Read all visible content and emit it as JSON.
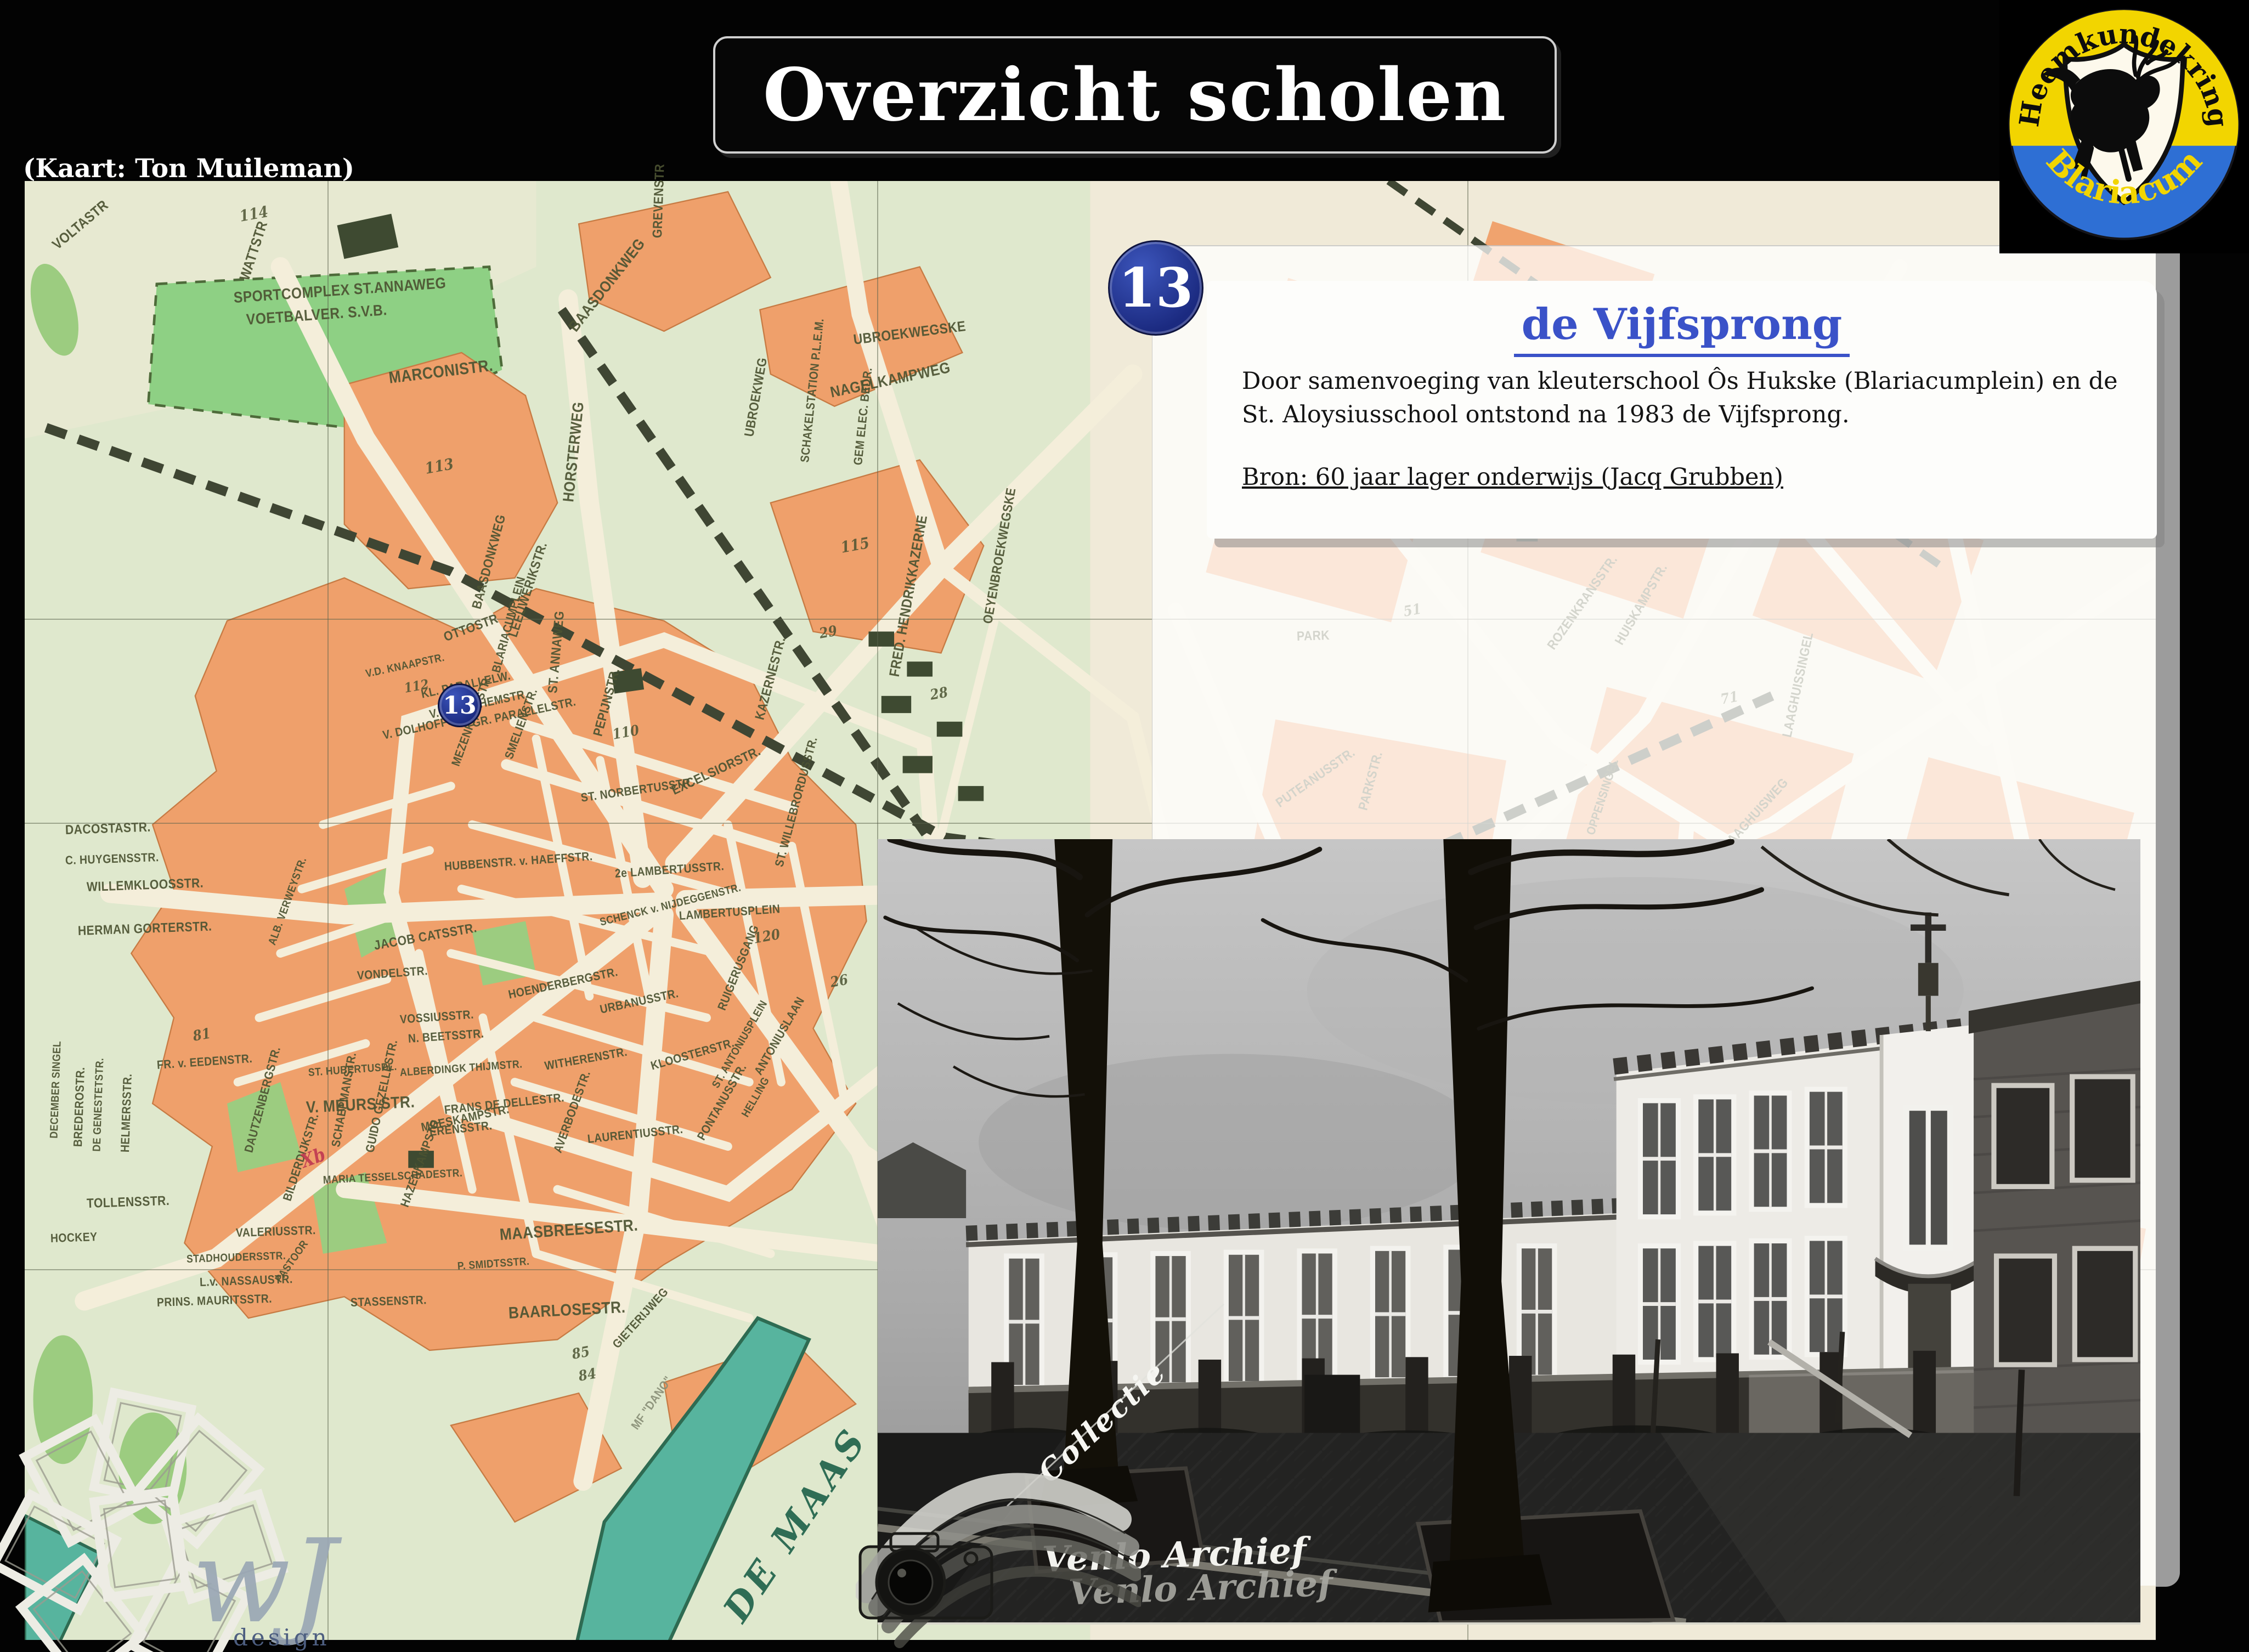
{
  "slide": {
    "title": "Overzicht scholen",
    "map_credit": "(Kaart: Ton Muileman)"
  },
  "logo": {
    "top": "Heemkundekring",
    "bottom": "Blariacum"
  },
  "marker": {
    "number": "13"
  },
  "card": {
    "title": "de Vijfsprong",
    "body": [
      "Door samenvoeging van kleuterschool Ôs Hukske (Blariacumplein) en de",
      "St. Aloysiusschool ontstond na 1983 de Vijfsprong."
    ],
    "source": "Bron: 60 jaar lager onderwijs (Jacq Grubben)"
  },
  "map": {
    "river_label": "DE MAAS",
    "labels": [
      {
        "t": "VOLTASTR",
        "x": 1.4,
        "y": 3.9,
        "r": -40,
        "fs": 26
      },
      {
        "t": "WATTSTR",
        "x": 10.3,
        "y": 6.2,
        "r": -72,
        "fs": 26
      },
      {
        "t": "MARCONISTR.",
        "x": 17.1,
        "y": 12.9,
        "r": -7,
        "fs": 30
      },
      {
        "t": "SPORTCOMPLEX  ST.ANNAWEG",
        "x": 9.8,
        "y": 7.4,
        "r": -4,
        "fs": 28
      },
      {
        "t": "VOETBALVER.  S.V.B.",
        "x": 10.4,
        "y": 8.9,
        "r": -4,
        "fs": 28
      },
      {
        "t": "BAASDONKWEG",
        "x": 25.7,
        "y": 9.6,
        "r": -52,
        "fs": 28
      },
      {
        "t": "BAASDONKWEG",
        "x": 21.2,
        "y": 28.8,
        "r": -75,
        "fs": 24
      },
      {
        "t": "ST. ANNAWEG",
        "x": 24.8,
        "y": 34.6,
        "r": -85,
        "fs": 24
      },
      {
        "t": "NAGELKAMPWEG",
        "x": 37.8,
        "y": 13.9,
        "r": -12,
        "fs": 28
      },
      {
        "t": "UBROEKWEGSKE",
        "x": 38.9,
        "y": 10.3,
        "r": -7,
        "fs": 26
      },
      {
        "t": "GREVENSTR",
        "x": 29.7,
        "y": 3.4,
        "r": -88,
        "fs": 24
      },
      {
        "t": "UBROEKWEG",
        "x": 34.0,
        "y": 17.0,
        "r": -80,
        "fs": 24
      },
      {
        "t": "HORSTERWEG",
        "x": 25.5,
        "y": 21.4,
        "r": -84,
        "fs": 28
      },
      {
        "t": "SCHAKELSTATION  P.L.E.M.",
        "x": 36.6,
        "y": 18.8,
        "r": -84,
        "fs": 22
      },
      {
        "t": "GEM ELEC. BEDR.",
        "x": 39.1,
        "y": 19.0,
        "r": -84,
        "fs": 22
      },
      {
        "t": "OEYENBROEKWEGSKE",
        "x": 45.2,
        "y": 29.8,
        "r": -80,
        "fs": 24
      },
      {
        "t": "FRED. HENDRIKKAZERNE",
        "x": 40.8,
        "y": 33.4,
        "r": -80,
        "fs": 26
      },
      {
        "t": "KAZERNESTR.",
        "x": 34.5,
        "y": 36.4,
        "r": -75,
        "fs": 24
      },
      {
        "t": "PEPIJNSTR.",
        "x": 26.9,
        "y": 37.5,
        "r": -75,
        "fs": 24
      },
      {
        "t": "LEEUWERIKSTR.",
        "x": 22.9,
        "y": 30.7,
        "r": -72,
        "fs": 24
      },
      {
        "t": "OTTOSTR",
        "x": 19.7,
        "y": 30.8,
        "r": -20,
        "fs": 24
      },
      {
        "t": "BLARIACUMPLEIN",
        "x": 22.1,
        "y": 33.2,
        "r": -75,
        "fs": 22
      },
      {
        "t": "V.D. KNAAPSTR.",
        "x": 16.0,
        "y": 33.4,
        "r": -12,
        "fs": 20
      },
      {
        "t": "KL. PARALLELW.",
        "x": 18.6,
        "y": 34.7,
        "r": -12,
        "fs": 22
      },
      {
        "t": "V. STOCKHEMSTR.",
        "x": 19.0,
        "y": 36.1,
        "r": -12,
        "fs": 22
      },
      {
        "t": "GR. PARALLELSTR.",
        "x": 21.0,
        "y": 36.7,
        "r": -12,
        "fs": 22
      },
      {
        "t": "V. DOLHOFFSTR.",
        "x": 16.8,
        "y": 37.5,
        "r": -12,
        "fs": 22
      },
      {
        "t": "MEZENKAMPSTR.",
        "x": 20.2,
        "y": 39.6,
        "r": -70,
        "fs": 22
      },
      {
        "t": "SMELIENSTR.",
        "x": 22.7,
        "y": 39.1,
        "r": -70,
        "fs": 22
      },
      {
        "t": "EXCELSIORSTR.",
        "x": 30.4,
        "y": 41.3,
        "r": -25,
        "fs": 24
      },
      {
        "t": "ST. NORBERTUSSTR.",
        "x": 26.1,
        "y": 41.8,
        "r": -8,
        "fs": 22
      },
      {
        "t": "ST. WILLEBRORDUSSTR.",
        "x": 35.4,
        "y": 46.5,
        "r": -75,
        "fs": 22
      },
      {
        "t": "WILLEMKLOOSSTR.",
        "x": 2.9,
        "y": 47.9,
        "r": -2,
        "fs": 24
      },
      {
        "t": "HERMAN GORTERSTR.",
        "x": 2.5,
        "y": 50.9,
        "r": -2,
        "fs": 24
      },
      {
        "t": "DACOSTASTR.",
        "x": 1.9,
        "y": 44.0,
        "r": -2,
        "fs": 24
      },
      {
        "t": "C. HUYGENSSTR.",
        "x": 1.9,
        "y": 46.1,
        "r": -2,
        "fs": 22
      },
      {
        "t": "JACOB CATSSTR.",
        "x": 16.4,
        "y": 51.9,
        "r": -10,
        "fs": 24
      },
      {
        "t": "HUBBENSTR. v. HAEFFSTR.",
        "x": 19.7,
        "y": 46.5,
        "r": -4,
        "fs": 22
      },
      {
        "t": "2e LAMBERTUSSTR.",
        "x": 27.7,
        "y": 47.0,
        "r": -4,
        "fs": 22
      },
      {
        "t": "LAMBERTUSPLEIN",
        "x": 30.7,
        "y": 49.9,
        "r": -4,
        "fs": 22
      },
      {
        "t": "SCHENCK v. NIJDEGGENSTR.",
        "x": 27.0,
        "y": 50.4,
        "r": -14,
        "fs": 20
      },
      {
        "t": "HOENDERBERGSTR.",
        "x": 22.7,
        "y": 55.3,
        "r": -12,
        "fs": 22
      },
      {
        "t": "URBANUSSTR.",
        "x": 27.0,
        "y": 56.3,
        "r": -12,
        "fs": 22
      },
      {
        "t": "RUIGERUSGANG",
        "x": 32.7,
        "y": 56.3,
        "r": -68,
        "fs": 22
      },
      {
        "t": "VONDELSTR.",
        "x": 15.6,
        "y": 54.0,
        "r": -4,
        "fs": 22
      },
      {
        "t": "ALB. VERWEYSTR.",
        "x": 11.6,
        "y": 51.9,
        "r": -70,
        "fs": 20
      },
      {
        "t": "VOSSIUSSTR.",
        "x": 17.6,
        "y": 57.0,
        "r": -4,
        "fs": 22
      },
      {
        "t": "N. BEETSSTR.",
        "x": 18.0,
        "y": 58.3,
        "r": -4,
        "fs": 22
      },
      {
        "t": "FR. v. EEDENSTR.",
        "x": 6.2,
        "y": 60.1,
        "r": -4,
        "fs": 22
      },
      {
        "t": "ST. HUBERTUSPL.",
        "x": 13.3,
        "y": 60.7,
        "r": -4,
        "fs": 20
      },
      {
        "t": "ALBERDINGK THIJMSTR.",
        "x": 17.6,
        "y": 60.7,
        "r": -4,
        "fs": 20
      },
      {
        "t": "WITHERENSTR.",
        "x": 24.4,
        "y": 60.2,
        "r": -10,
        "fs": 22
      },
      {
        "t": "KLOOSTERSTR.",
        "x": 29.4,
        "y": 60.2,
        "r": -16,
        "fs": 22
      },
      {
        "t": "ST. ANTONIUSPLEIN",
        "x": 32.4,
        "y": 61.7,
        "r": -60,
        "fs": 20
      },
      {
        "t": "ANTONIUSLAAN",
        "x": 34.4,
        "y": 60.7,
        "r": -60,
        "fs": 22
      },
      {
        "t": "V. MEURS STR.",
        "x": 13.2,
        "y": 62.9,
        "r": -3,
        "fs": 30
      },
      {
        "t": "DAUTZENBERGSTR.",
        "x": 10.5,
        "y": 66.1,
        "r": -75,
        "fs": 22
      },
      {
        "t": "BILDERDIJKSTR.",
        "x": 12.3,
        "y": 69.4,
        "r": -72,
        "fs": 22
      },
      {
        "t": "SCHAEPMANSTR.",
        "x": 14.6,
        "y": 65.7,
        "r": -80,
        "fs": 22
      },
      {
        "t": "MARIA TESSELSCHADESTR.",
        "x": 14.0,
        "y": 68.1,
        "r": -3,
        "fs": 20
      },
      {
        "t": "GUIDO GEZELLESTR.",
        "x": 16.2,
        "y": 66.1,
        "r": -78,
        "fs": 22
      },
      {
        "t": "HAZENKAMPSTR.",
        "x": 17.8,
        "y": 69.8,
        "r": -70,
        "fs": 22
      },
      {
        "t": "FRANS DE DELLESTR.",
        "x": 19.7,
        "y": 63.2,
        "r": -6,
        "fs": 22
      },
      {
        "t": "ERENSSTR.",
        "x": 19.0,
        "y": 64.7,
        "r": -6,
        "fs": 22
      },
      {
        "t": "LAURENTIUSSTR.",
        "x": 26.4,
        "y": 65.2,
        "r": -6,
        "fs": 22
      },
      {
        "t": "MOESKAMPSTR.",
        "x": 18.6,
        "y": 64.4,
        "r": -12,
        "fs": 22
      },
      {
        "t": "AVERBODESTR.",
        "x": 25.0,
        "y": 66.1,
        "r": -70,
        "fs": 22
      },
      {
        "t": "PONTANUSSTR.",
        "x": 31.7,
        "y": 65.2,
        "r": -60,
        "fs": 22
      },
      {
        "t": "HELLING",
        "x": 33.8,
        "y": 63.7,
        "r": -60,
        "fs": 20
      },
      {
        "t": "BREDEROSTR.",
        "x": 2.5,
        "y": 65.7,
        "r": -88,
        "fs": 22
      },
      {
        "t": "DE GENESTETSTR.",
        "x": 3.4,
        "y": 66.1,
        "r": -88,
        "fs": 20
      },
      {
        "t": "HELMERSSTR.",
        "x": 4.7,
        "y": 66.1,
        "r": -88,
        "fs": 22
      },
      {
        "t": "DECEMBER SINGEL",
        "x": 1.4,
        "y": 65.2,
        "r": -88,
        "fs": 20
      },
      {
        "t": "TOLLENSSTR.",
        "x": 2.9,
        "y": 69.6,
        "r": -2,
        "fs": 24
      },
      {
        "t": "MAASBREESESTR.",
        "x": 22.3,
        "y": 71.6,
        "r": -4,
        "fs": 30
      },
      {
        "t": "VALERIUSSTR.",
        "x": 9.9,
        "y": 71.6,
        "r": -2,
        "fs": 22
      },
      {
        "t": "HOCKEY",
        "x": 1.2,
        "y": 72.0,
        "r": -2,
        "fs": 22
      },
      {
        "t": "STADHOUDERSSTR.",
        "x": 7.6,
        "y": 73.5,
        "r": -2,
        "fs": 20
      },
      {
        "t": "L.v. NASSAUSTR.",
        "x": 8.2,
        "y": 75.0,
        "r": -2,
        "fs": 22
      },
      {
        "t": "PASTOOR",
        "x": 11.9,
        "y": 75.0,
        "r": -55,
        "fs": 20
      },
      {
        "t": "STASSENSTR.",
        "x": 15.3,
        "y": 76.4,
        "r": -2,
        "fs": 22
      },
      {
        "t": "PRINS. MAURITSSTR.",
        "x": 6.2,
        "y": 76.4,
        "r": -2,
        "fs": 22
      },
      {
        "t": "P. SMIDTSSTR.",
        "x": 20.3,
        "y": 74.0,
        "r": -4,
        "fs": 20
      },
      {
        "t": "BAARLOSESTR.",
        "x": 22.7,
        "y": 77.0,
        "r": -3,
        "fs": 30
      },
      {
        "t": "GIETERIJWEG",
        "x": 27.7,
        "y": 79.4,
        "r": -48,
        "fs": 22
      },
      {
        "t": "MF \"DANO\"",
        "x": 28.6,
        "y": 85.0,
        "r": -55,
        "fs": 22,
        "c": "mghost"
      },
      {
        "t": "Xb",
        "x": 13.0,
        "y": 66.5,
        "r": -20,
        "fs": 34,
        "c": "mred"
      },
      {
        "t": "PARK",
        "x": 59.7,
        "y": 30.7,
        "r": -2,
        "fs": 24
      },
      {
        "t": "PUTEANUSSTR.",
        "x": 58.8,
        "y": 42.2,
        "r": -35,
        "fs": 24
      },
      {
        "t": "PARKSTR.",
        "x": 62.8,
        "y": 42.6,
        "r": -75,
        "fs": 24
      },
      {
        "t": "ROZENKRANSSTR.",
        "x": 71.6,
        "y": 31.5,
        "r": -55,
        "fs": 24
      },
      {
        "t": "HUISKAMPSTR.",
        "x": 74.8,
        "y": 31.2,
        "r": -60,
        "fs": 24
      },
      {
        "t": "DEKEN v. OPPENSINGEL",
        "x": 72.7,
        "y": 47.8,
        "r": -72,
        "fs": 22
      },
      {
        "t": "MERCATORSTR.",
        "x": 70.3,
        "y": 53.9,
        "r": -58,
        "fs": 24
      },
      {
        "t": "ST. MARTINUSSTR.",
        "x": 62.6,
        "y": 53.4,
        "r": -72,
        "fs": 22
      },
      {
        "t": "WILHELMINASINGEL",
        "x": 66.0,
        "y": 53.6,
        "r": -78,
        "fs": 22
      },
      {
        "t": "LAAGHUISSINGEL",
        "x": 82.7,
        "y": 37.6,
        "r": -78,
        "fs": 24
      },
      {
        "t": "LAAGHUISWEG",
        "x": 79.8,
        "y": 45.2,
        "r": -48,
        "fs": 24
      },
      {
        "t": "RIJNBEEKSTR.",
        "x": 80.4,
        "y": 58.1,
        "r": -38,
        "fs": 24
      },
      {
        "t": "MULDERSTR.",
        "x": 75.3,
        "y": 61.0,
        "r": -8,
        "fs": 24
      },
      {
        "t": "114",
        "x": 10.1,
        "y": 1.8,
        "r": -10,
        "fs": 28,
        "c": "mnum"
      },
      {
        "t": "113",
        "x": 18.8,
        "y": 19.1,
        "r": -10,
        "fs": 28,
        "c": "mnum"
      },
      {
        "t": "115",
        "x": 38.3,
        "y": 24.5,
        "r": -10,
        "fs": 28,
        "c": "mnum"
      },
      {
        "t": "112",
        "x": 17.8,
        "y": 34.2,
        "r": -10,
        "fs": 24,
        "c": "mnum"
      },
      {
        "t": "29",
        "x": 37.3,
        "y": 30.5,
        "r": -10,
        "fs": 26,
        "c": "mnum"
      },
      {
        "t": "28",
        "x": 42.5,
        "y": 34.7,
        "r": -10,
        "fs": 26,
        "c": "mnum"
      },
      {
        "t": "110",
        "x": 27.6,
        "y": 37.4,
        "r": -10,
        "fs": 26,
        "c": "mnum"
      },
      {
        "t": "120",
        "x": 34.2,
        "y": 51.4,
        "r": -10,
        "fs": 26,
        "c": "mnum"
      },
      {
        "t": "26",
        "x": 37.8,
        "y": 54.4,
        "r": -10,
        "fs": 26,
        "c": "mnum"
      },
      {
        "t": "81",
        "x": 7.9,
        "y": 58.1,
        "r": -10,
        "fs": 26,
        "c": "mnum"
      },
      {
        "t": "85",
        "x": 25.7,
        "y": 79.9,
        "r": -10,
        "fs": 26,
        "c": "mnum"
      },
      {
        "t": "84",
        "x": 26.0,
        "y": 81.4,
        "r": -10,
        "fs": 26,
        "c": "mnum"
      },
      {
        "t": "51",
        "x": 64.7,
        "y": 29.0,
        "r": -10,
        "fs": 26,
        "c": "mnum"
      },
      {
        "t": "71",
        "x": 79.6,
        "y": 35.0,
        "r": -10,
        "fs": 26,
        "c": "mnum"
      },
      {
        "t": "90",
        "x": 64.7,
        "y": 50.0,
        "r": -10,
        "fs": 26,
        "c": "mnum"
      },
      {
        "t": "116",
        "x": 57.2,
        "y": 57.6,
        "r": -10,
        "fs": 26,
        "c": "mnum"
      }
    ]
  },
  "watermarks": {
    "collectie": "Collectie",
    "venlo": "Venlo Archief",
    "venlo_shadow": "Venlo Archief",
    "wj_script": "wJ",
    "wj_design": "design"
  },
  "colors": {
    "heading_blue": "#3a52c8",
    "badge_blue": "#1b2a80",
    "map_orange": "#efa06b",
    "river_teal": "#57b49e",
    "logo_yellow": "#f2d500",
    "logo_blue": "#2e6fd4"
  }
}
